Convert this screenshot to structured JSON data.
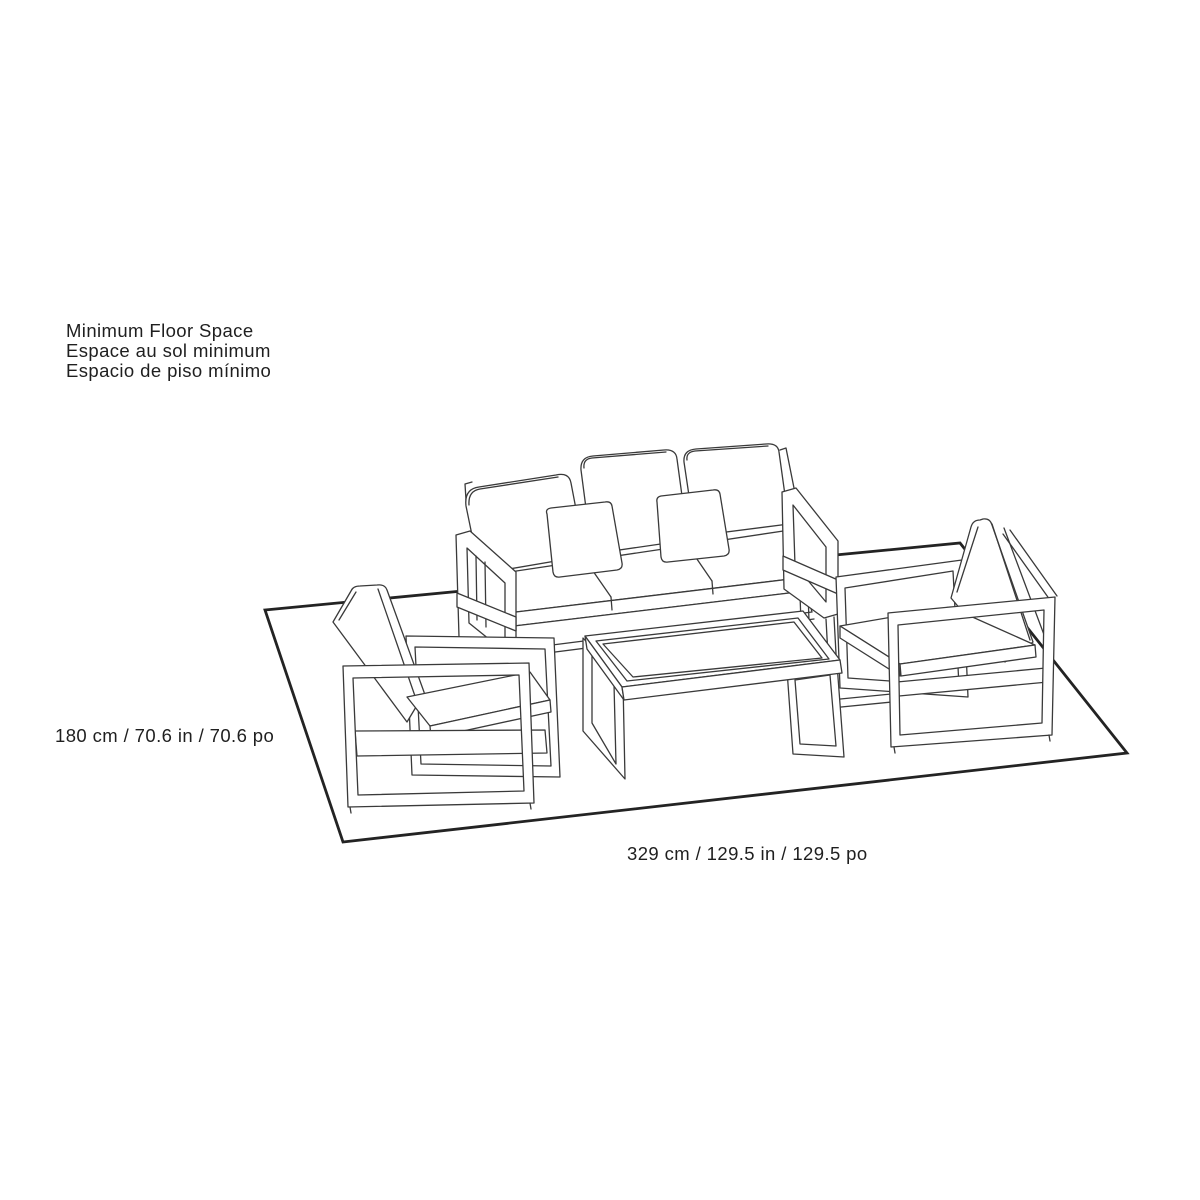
{
  "canvas": {
    "width": 1200,
    "height": 1200,
    "background": "#ffffff"
  },
  "style": {
    "furniture_line_color": "#3a3a3a",
    "floor_outline_color": "#232323",
    "label_color": "#1f1f1f"
  },
  "labels": {
    "title_lines": [
      "Minimum Floor Space",
      "Espace au sol minimum",
      "Espacio de piso mínimo"
    ],
    "depth_dimension": "180 cm / 70.6 in / 70.6 po",
    "width_dimension": "329 cm / 129.5 in / 129.5 po"
  },
  "figure": {
    "kind": "isometric line drawing",
    "floor_outline": "minimum floor space rectangle",
    "furniture": [
      "three-seat sofa with two throw pillows",
      "armchair (left)",
      "armchair (right)",
      "rectangular coffee table"
    ]
  }
}
